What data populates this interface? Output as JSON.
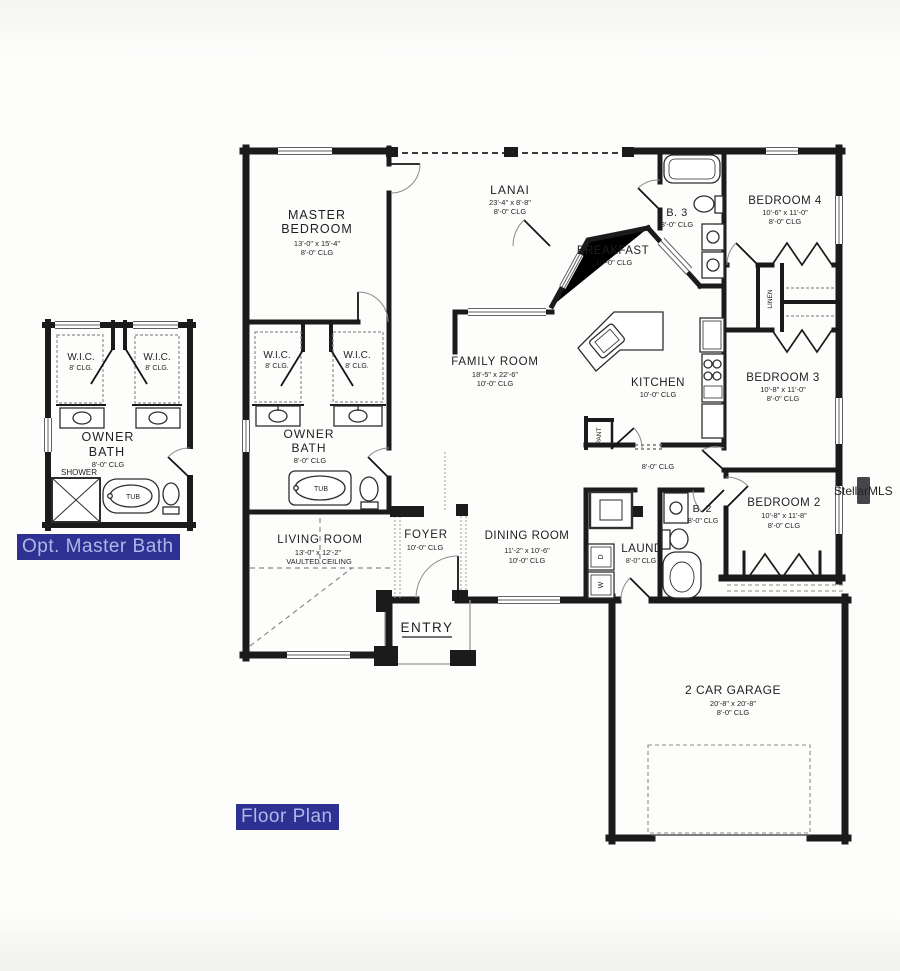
{
  "badges": {
    "opt_master_bath": "Opt. Master Bath",
    "floor_plan": "Floor Plan",
    "badge_bg": "#2e3192",
    "badge_fg": "#b0b6e8"
  },
  "watermark": "StellarMLS",
  "colors": {
    "wall": "#1b1b1b",
    "paper": "#fdfdfc"
  },
  "detail": {
    "wic1": {
      "name": "W.I.C.",
      "clg": "8' CLG."
    },
    "wic2": {
      "name": "W.I.C.",
      "clg": "8' CLG."
    },
    "owner_bath": {
      "l1": "OWNER",
      "l2": "BATH",
      "clg": "8'-0\" CLG"
    },
    "shower": "SHOWER",
    "tub": "TUB"
  },
  "main": {
    "master": {
      "l1": "MASTER",
      "l2": "BEDROOM",
      "dims": "13'-0\" x 15'-4\"",
      "clg": "8'-0\" CLG"
    },
    "lanai": {
      "name": "LANAI",
      "dims": "23'-4\" x 8'-8\"",
      "clg": "8'-0\" CLG"
    },
    "b3": {
      "name": "B. 3",
      "clg": "8'-0\" CLG"
    },
    "bedroom4": {
      "name": "BEDROOM 4",
      "dims": "10'-6\" x 11'-0\"",
      "clg": "8'-0\" CLG"
    },
    "breakfast": {
      "name": "BREAKFAST",
      "clg": "10'-0\" CLG"
    },
    "family": {
      "name": "FAMILY ROOM",
      "dims": "18'-5\" x 22'-6\"",
      "clg": "10'-0\" CLG"
    },
    "kitchen": {
      "name": "KITCHEN",
      "clg": "10'-0\" CLG"
    },
    "bedroom3": {
      "name": "BEDROOM 3",
      "dims": "10'-8\" x 11'-0\"",
      "clg": "8'-0\" CLG"
    },
    "wic1": {
      "name": "W.I.C.",
      "clg": "8' CLG."
    },
    "wic2": {
      "name": "W.I.C.",
      "clg": "8' CLG."
    },
    "owner_bath": {
      "l1": "OWNER",
      "l2": "BATH",
      "clg": "8'-0\" CLG"
    },
    "tub": "TUB",
    "hall_clg": "8'-0\" CLG",
    "bedroom2": {
      "name": "BEDROOM 2",
      "dims": "10'-8\" x 11'-8\"",
      "clg": "8'-0\" CLG"
    },
    "b2": {
      "name": "B. 2",
      "clg": "8'-0\" CLG"
    },
    "laundry": {
      "name": "LAUND",
      "clg": "8'-0\" CLG",
      "dryer": "D",
      "washer": "W"
    },
    "living": {
      "name": "LIVING ROOM",
      "dims": "13'-0\" x 12'-2\"",
      "clg": "VAULTED CEILING"
    },
    "foyer": {
      "name": "FOYER",
      "clg": "10'-0\" CLG"
    },
    "dining": {
      "name": "DINING ROOM",
      "dims": "11'-2\" x 10'-6\"",
      "clg": "10'-0\" CLG"
    },
    "entry": "ENTRY",
    "garage": {
      "name": "2 CAR GARAGE",
      "dims": "20'-8\" x 20'-8\"",
      "clg": "8'-0\" CLG"
    },
    "pantry": "PANT",
    "linen": "LINEN"
  }
}
